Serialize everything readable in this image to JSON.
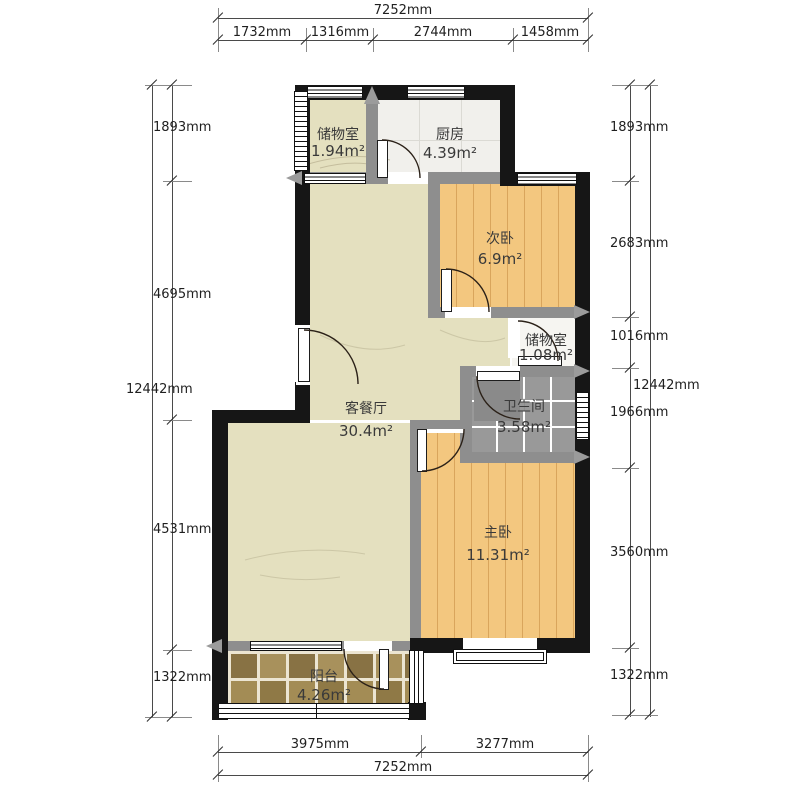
{
  "title": "apartment-floor-plan",
  "rooms": [
    {
      "name": "储物室",
      "area": "1.94m²"
    },
    {
      "name": "厨房",
      "area": "4.39m²"
    },
    {
      "name": "次卧",
      "area": "6.9m²"
    },
    {
      "name": "储物室",
      "area": "1.08m²"
    },
    {
      "name": "卫生间",
      "area": "3.58m²"
    },
    {
      "name": "客餐厅",
      "area": "30.4m²"
    },
    {
      "name": "主卧",
      "area": "11.31m²"
    },
    {
      "name": "阳台",
      "area": "4.26m²"
    }
  ],
  "dims": {
    "top": {
      "total": "7252mm",
      "segments": [
        "1732mm",
        "1316mm",
        "2744mm",
        "1458mm"
      ]
    },
    "bottom": {
      "total": "7252mm",
      "segments": [
        "3975mm",
        "3277mm"
      ]
    },
    "left": {
      "total": "12442mm",
      "segments": [
        "1893mm",
        "4695mm",
        "4531mm",
        "1322mm"
      ]
    },
    "right": {
      "total": "12442mm",
      "segments": [
        "1893mm",
        "2683mm",
        "1016mm",
        "1966mm",
        "3560mm",
        "1322mm"
      ]
    }
  },
  "colors": {
    "exterior_wall": "#161616",
    "interior_wall": "#8e8e8e",
    "living_floor": "#e4e0bf",
    "wood_floor": "#f3c77f",
    "kitchen_floor": "#f1f0ec",
    "bath_floor": "#999999",
    "balcony_tile": "#9c8550",
    "dimension_text": "#1f1f1f"
  }
}
